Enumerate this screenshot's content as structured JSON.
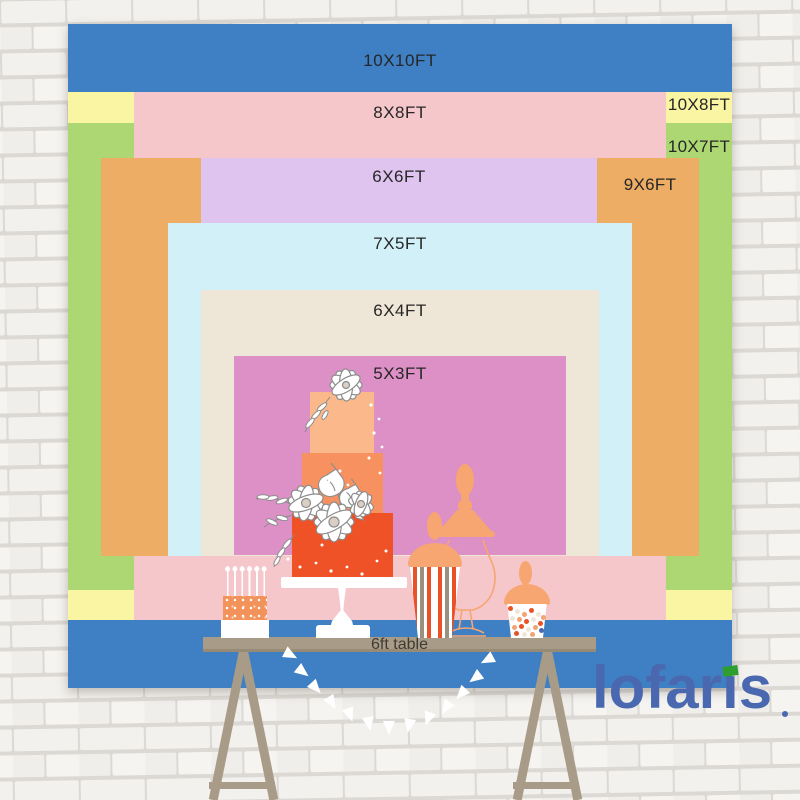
{
  "diagram": {
    "title_context": "backdrop size comparison",
    "backdrop_sizes": [
      {
        "label": "10X10FT",
        "color": "#3F80C4"
      },
      {
        "label": "10X8FT",
        "color": "#F9F5A3"
      },
      {
        "label": "10X7FT",
        "color": "#ACD772"
      },
      {
        "label": "8X8FT",
        "color": "#F5C7CB"
      },
      {
        "label": "9X6FT",
        "color": "#EDAD64"
      },
      {
        "label": "6X6FT",
        "color": "#DFC4EF"
      },
      {
        "label": "7X5FT",
        "color": "#D2F0F8"
      },
      {
        "label": "6X4FT",
        "color": "#EEE6D6"
      },
      {
        "label": "5X3FT",
        "color": "#DC90C6"
      }
    ],
    "table_label": "6ft table"
  },
  "logo": {
    "text": "lofaris",
    "display_parts": [
      "lofar",
      "ı",
      "s"
    ],
    "color": "#4A68AF",
    "accent_color": "#2E9E2E"
  },
  "palette": {
    "table": "#A89B87",
    "cake_top_tier": "#FBB98B",
    "cake_middle_tier": "#F79260",
    "cake_bottom_tier": "#EE5226",
    "jar_peach": "#F7A571"
  }
}
